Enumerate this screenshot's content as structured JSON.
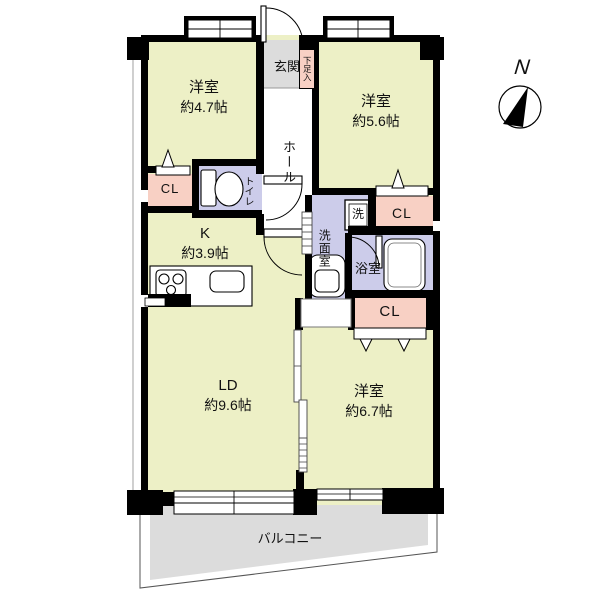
{
  "plan": {
    "compass_label": "N",
    "balcony_label": "バルコニー",
    "rooms": {
      "bedroom_nw": {
        "name": "洋室",
        "size": "約4.7帖"
      },
      "bedroom_ne": {
        "name": "洋室",
        "size": "約5.6帖"
      },
      "bedroom_se": {
        "name": "洋室",
        "size": "約6.7帖"
      },
      "kitchen": {
        "name": "K",
        "size": "約3.9帖"
      },
      "living_dining": {
        "name": "LD",
        "size": "約9.6帖"
      },
      "entrance": {
        "name": "玄関"
      },
      "shoe_cabinet": {
        "name": "下足入"
      },
      "hall": {
        "name": "ホール"
      },
      "toilet": {
        "name": "トイレ"
      },
      "washroom": {
        "name": "洗面室"
      },
      "washer": {
        "name": "洗"
      },
      "bathroom": {
        "name": "浴室"
      },
      "closet_west": {
        "name": "CL"
      },
      "closet_east": {
        "name": "CL"
      },
      "closet_south": {
        "name": "CL"
      }
    },
    "colors": {
      "room_fill": "#edf0c6",
      "service_fill": "#dcdcdc",
      "closet_fill": "#f8d0c4",
      "wet_area_fill": "#ccccea",
      "wall": "#000000"
    }
  }
}
